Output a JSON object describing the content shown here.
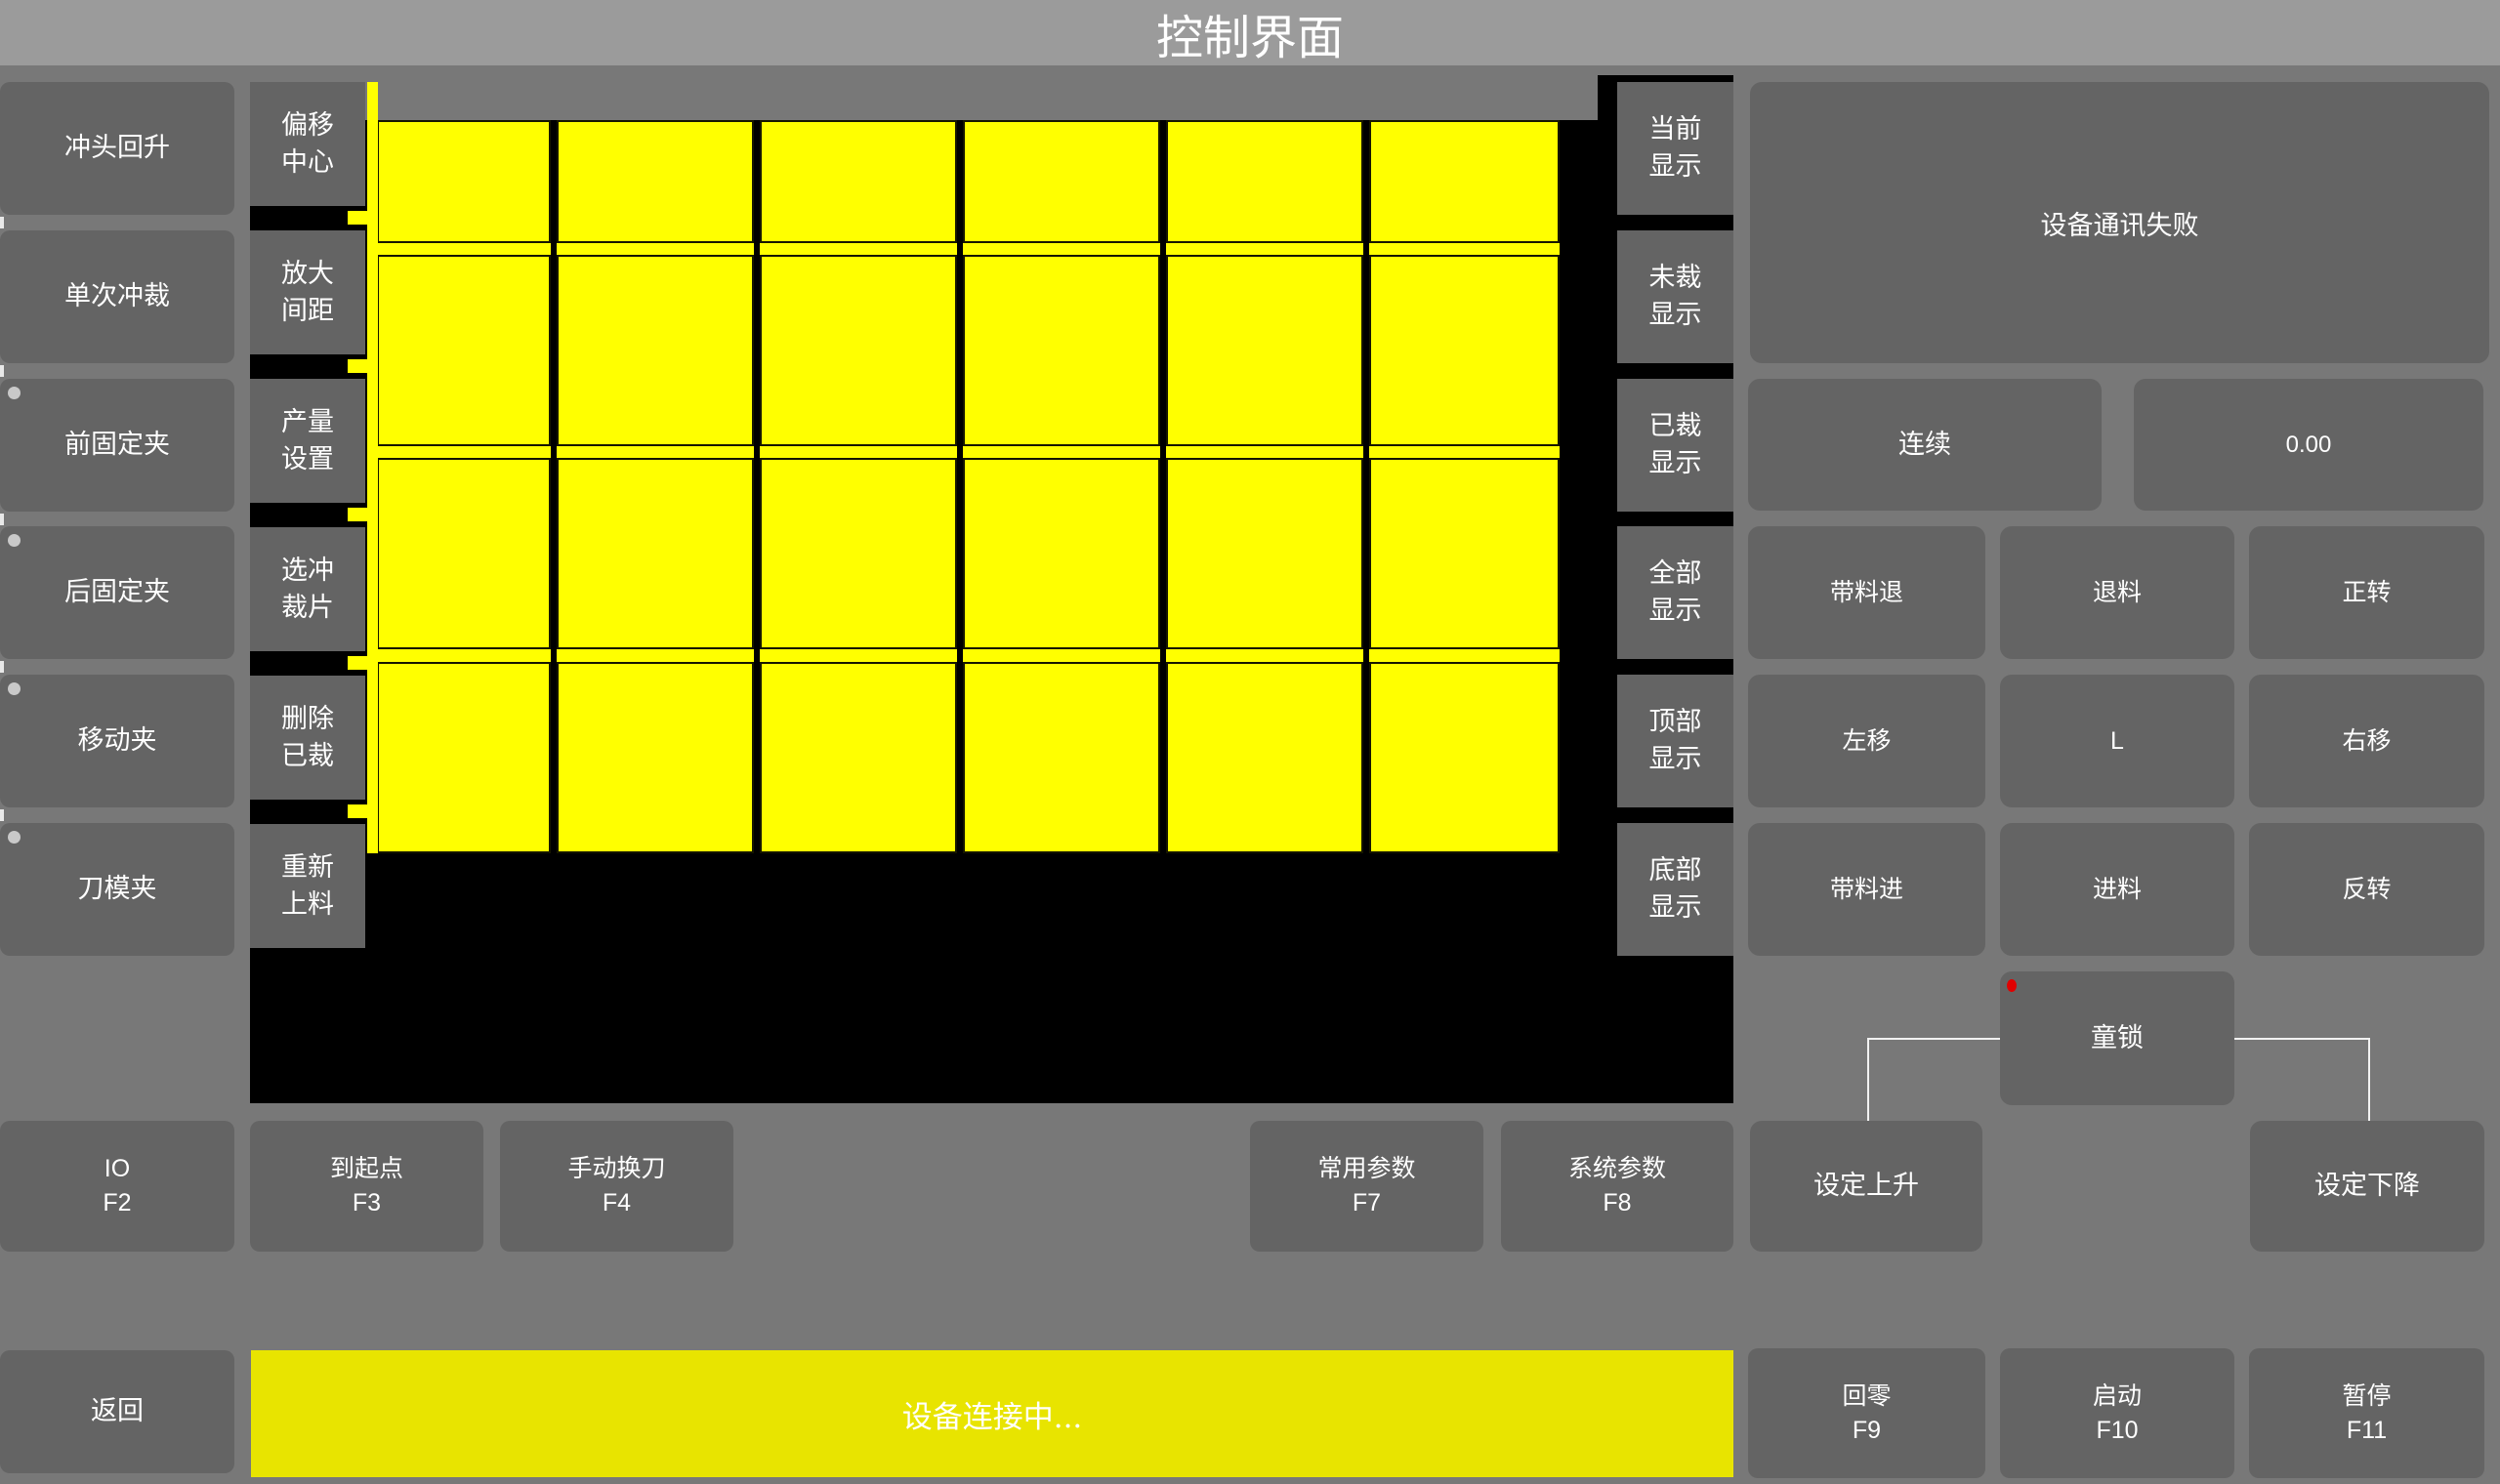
{
  "title_bar": {
    "title": "控制界面"
  },
  "left_panel": {
    "buttons": [
      {
        "label": "冲头回升",
        "indicator": false
      },
      {
        "label": "单次冲裁",
        "indicator": false
      },
      {
        "label": "前固定夹",
        "indicator": true
      },
      {
        "label": "后固定夹",
        "indicator": true
      },
      {
        "label": "移动夹",
        "indicator": true
      },
      {
        "label": "刀模夹",
        "indicator": true
      }
    ]
  },
  "tool_column": {
    "buttons": [
      "偏移\n中心",
      "放大\n间距",
      "产量\n设置",
      "选冲\n裁片",
      "删除\n已裁",
      "重新\n上料"
    ]
  },
  "display_column": {
    "buttons": [
      "当前\n显示",
      "未裁\n显示",
      "已裁\n显示",
      "全部\n显示",
      "顶部\n显示",
      "底部\n显示"
    ]
  },
  "workpiece_view": {
    "grid_rows": 4,
    "grid_cols": 6,
    "piece_color": "#ffff00",
    "background": "#000000",
    "uncut_pieces": 24,
    "partial_strip_on_left": true
  },
  "right_panel": {
    "message_box": "设备通讯失败",
    "mode_button": "连续",
    "value_display": "0.00",
    "jog_buttons": [
      [
        "带料退",
        "退料",
        "正转"
      ],
      [
        "左移",
        "L",
        "右移"
      ],
      [
        "带料进",
        "进料",
        "反转"
      ]
    ],
    "child_lock": {
      "label": "童锁",
      "indicator_color": "#e00000"
    },
    "set_up": "设定上升",
    "set_down": "设定下降"
  },
  "function_row": {
    "buttons": [
      "IO\nF2",
      "到起点\nF3",
      "手动换刀\nF4",
      "常用参数\nF7",
      "系统参数\nF8"
    ]
  },
  "status_bar": {
    "back": "返回",
    "message": "设备连接中...",
    "buttons": [
      "回零\nF9",
      "启动\nF10",
      "暂停\nF11"
    ]
  },
  "colors": {
    "page_background": "#787878",
    "top_bar": "#9b9b9b",
    "button": "#646464",
    "canvas": "#000000",
    "piece_yellow": "#ffff00",
    "status_yellow": "#e8e400",
    "indicator_gray": "#c9c9c9",
    "indicator_red": "#e00000"
  }
}
